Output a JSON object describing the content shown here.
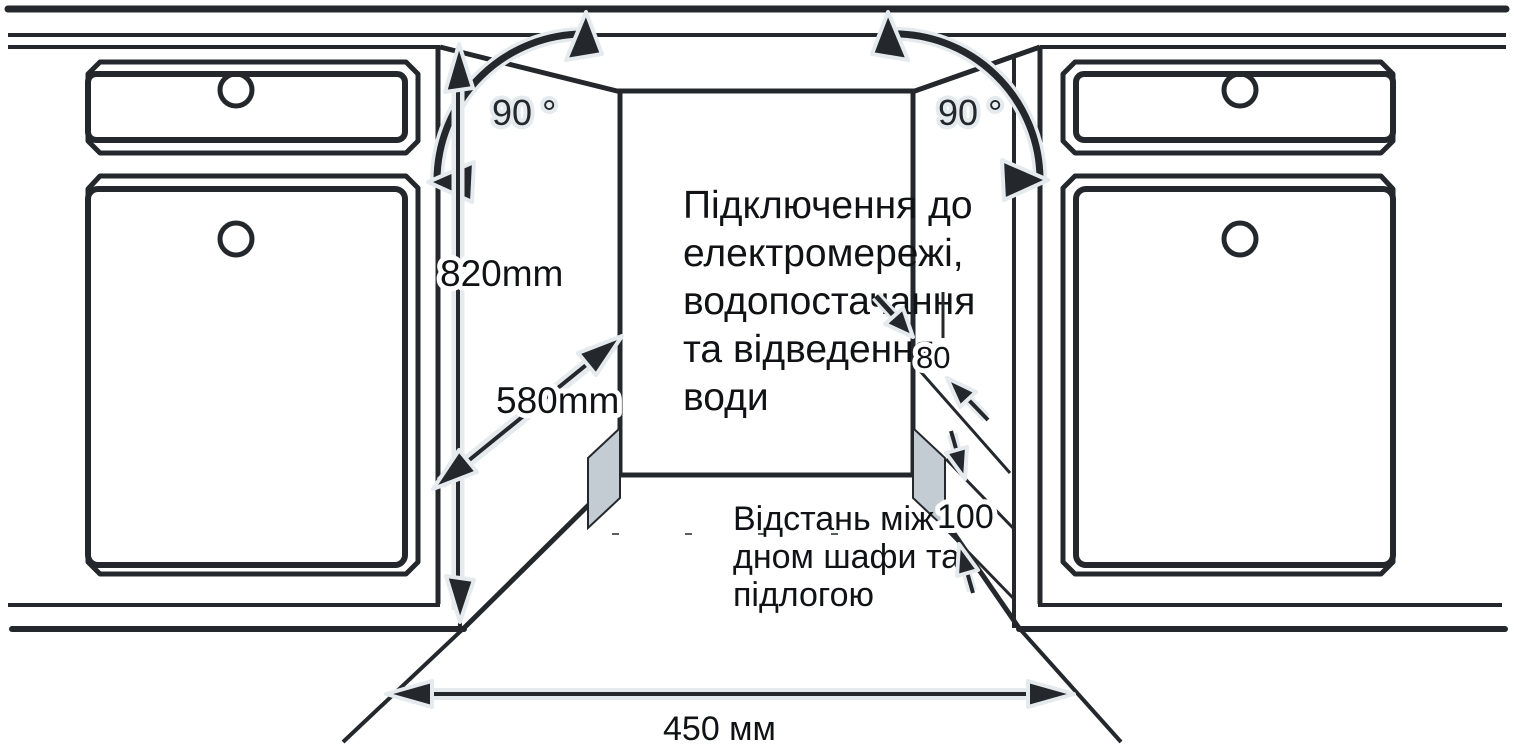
{
  "diagram": {
    "title": "Built-in appliance niche installation diagram",
    "labels": {
      "angle_left": "90 °",
      "angle_right": "90 °",
      "height_dim": "820mm",
      "depth_dim": "580mm",
      "utility_offset_dim": "80",
      "plinth_gap_dim": "100",
      "width_dim": "450 мм",
      "utilities_note": {
        "lines": [
          "Підключення до",
          "електромережі,",
          "водопостачання",
          "та відведення",
          "води"
        ]
      },
      "floor_note": {
        "lines": [
          "Відстань між",
          "дном шафи та",
          "підлогою"
        ]
      }
    },
    "colors": {
      "line": "#24282c",
      "halo": "#e4eaed",
      "panel_gray": "#c3ccd3",
      "background": "#ffffff"
    }
  }
}
